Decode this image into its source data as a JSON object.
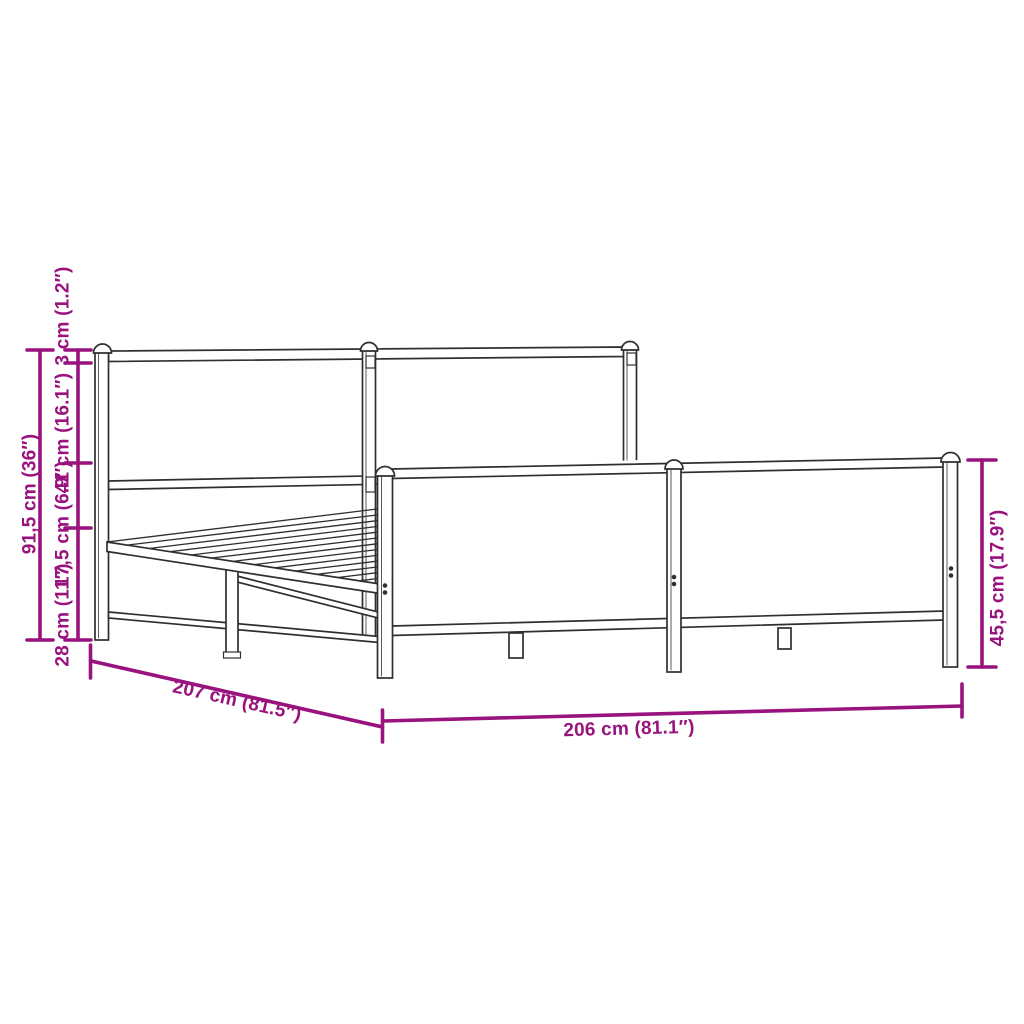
{
  "diagram": {
    "accent_color": "#99127E",
    "line_color": "#2F2F2F",
    "labels": {
      "total_height": "91,5 cm (36″)",
      "top_segment": "3 cm (1.2″)",
      "headboard_panel": "41 cm (16.1″)",
      "base_height": "17,5 cm (6.9″)",
      "under_clearance": "28 cm (11″)",
      "frame_length": "207 cm (81.5″)",
      "frame_width": "206 cm (81.1″)",
      "footboard_height": "45,5 cm (17.9″)"
    }
  }
}
